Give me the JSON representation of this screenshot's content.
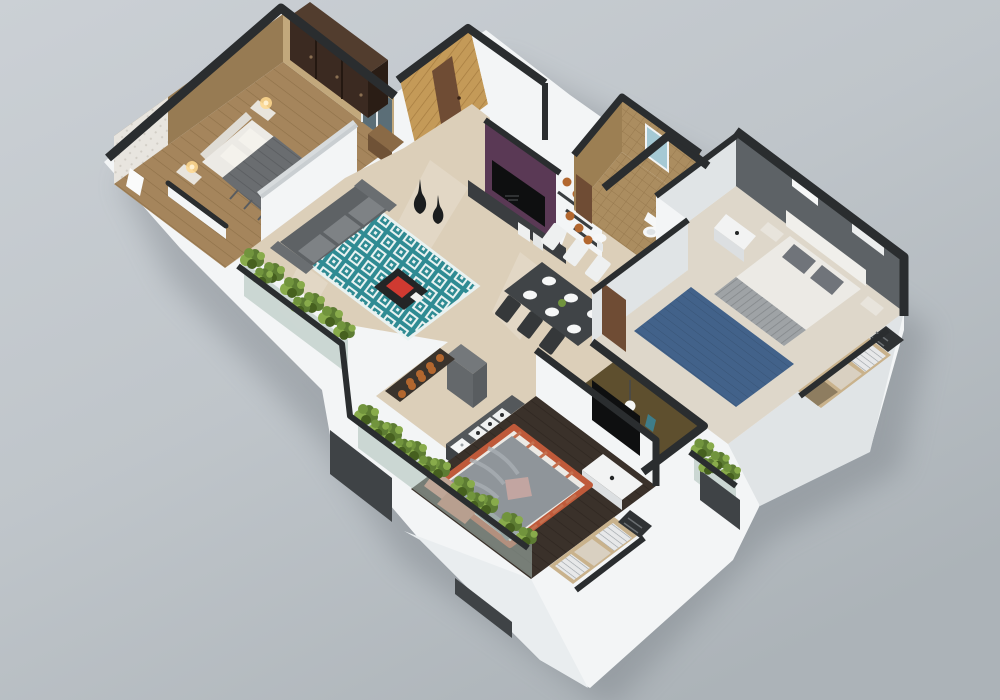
{
  "scene": {
    "type": "3d-floor-plan-render",
    "view": "isometric-cutaway",
    "subject": "two-bedroom apartment 3D floor plan",
    "rooms": [
      {
        "name": "master-bedroom",
        "features": [
          "double-bed",
          "wardrobe",
          "nightstand-lamps",
          "foyer-wallpaper",
          "dresser"
        ]
      },
      {
        "name": "living-room",
        "features": [
          "gray-sofa",
          "teal-diamond-rug",
          "coffee-table-red-cushion",
          "purple-tv-wall",
          "decor-vases"
        ]
      },
      {
        "name": "entrance",
        "features": [
          "wood-panel-wall",
          "brown-door"
        ]
      },
      {
        "name": "bathroom",
        "features": [
          "mosaic-tile",
          "toilet",
          "window",
          "basin"
        ]
      },
      {
        "name": "dining-area",
        "features": [
          "dark-table",
          "six-plates",
          "white-chairs",
          "dark-chairs",
          "plant-centerpiece"
        ]
      },
      {
        "name": "kitchen",
        "features": [
          "hob-counter",
          "sink",
          "cabinet",
          "pot-shelf"
        ]
      },
      {
        "name": "bedroom-right",
        "features": [
          "white-bed",
          "blue-rug",
          "gray-accent-wall",
          "vanity",
          "window-seat-cushions"
        ]
      },
      {
        "name": "walk-in-wardrobe",
        "features": [
          "gold-louver-doors",
          "pendant-lamp"
        ]
      },
      {
        "name": "bedroom-bottom",
        "features": [
          "gray-duvet-bed",
          "salmon-pillows",
          "tv-console",
          "dark-wood-floor",
          "window-seat-cushions"
        ]
      },
      {
        "name": "balconies",
        "features": [
          "planter-hedges",
          "glass-parapet"
        ]
      }
    ]
  },
  "palette": {
    "bg_top": "#c9ced3",
    "bg_bottom": "#aeb5ba",
    "shadow": "#5a6167",
    "wall_white": "#f3f5f6",
    "wall_shade": "#e0e4e6",
    "cap": "#2a2d2f",
    "master_wall_light": "#c2a87c",
    "master_wall_dark": "#977b53",
    "master_floor": "#a5855c",
    "wardrobe_front": "#3b2a21",
    "wardrobe_top": "#523d2e",
    "wardrobe_side": "#2a1d15",
    "bed_white": "#eceae5",
    "pillow_white": "#f4f2ec",
    "blanket_master": "#6a6d70",
    "lamp_glow": "#ffd98f",
    "wallpaper": "#e8e5df",
    "marble": "#dccfb9",
    "rug_teal": "#2f8b93",
    "rug_pattern": "#e9f2f1",
    "sofa_back": "#5e6265",
    "sofa_seat": "#7e8285",
    "sofa_arm": "#6a6e71",
    "table_black": "#232526",
    "cushion_red": "#cf3a31",
    "purple_wall": "#5a3955",
    "tv_black": "#0e0f10",
    "console_gray": "#3a3d40",
    "wood_wall": "#c49a58",
    "wood_wall_line": "#a67c40",
    "door_brown": "#6f4c34",
    "vase_black": "#1b1d1e",
    "pot_orange": "#b2672f",
    "pot_rim": "#7e461f",
    "tile_base": "#ab8d60",
    "tile_dark": "#9c7f53",
    "tile_line": "#97794e",
    "window_glass": "#a5c9d4",
    "glass_dark": "#5b6e77",
    "dine_table": "#404447",
    "chair_white": "#eef0f0",
    "chair_dark": "#35383a",
    "plate_white": "#f6f7f7",
    "gray_wall": "#5d6266",
    "gray_wall_light": "#6d7276",
    "blue_rug": "#42628a",
    "runner_gray": "#9fa3a6",
    "pillow_gray": "#70747a",
    "ledge_wood": "#c9b28c",
    "cushion_cream": "#d9d0c1",
    "cushion_stripe": "#e7e8e9",
    "cushion_brown": "#8e7d60",
    "gold_louver": "#b3903f",
    "gold_line": "#8d6d2e",
    "dark_floor": "#3a312a",
    "dark_floor_line": "#2e2620",
    "blanket_bottom": "#8f959a",
    "blanket_bottom_light": "#a8aeb3",
    "salmon": "#d98a72",
    "salmon_dark": "#c97a5f",
    "bolster_orange": "#bf5a3a",
    "pink_cloth": "#c2a5a1",
    "counter_top": "#54585b",
    "fridge_gray": "#74787b",
    "glass_green": "#a9bdb7",
    "parapet_dark": "#3f4346",
    "plant_a": "#5d7c33",
    "plant_b": "#71943d",
    "plant_c": "#88ab4b",
    "plant_dark": "#46601f"
  }
}
